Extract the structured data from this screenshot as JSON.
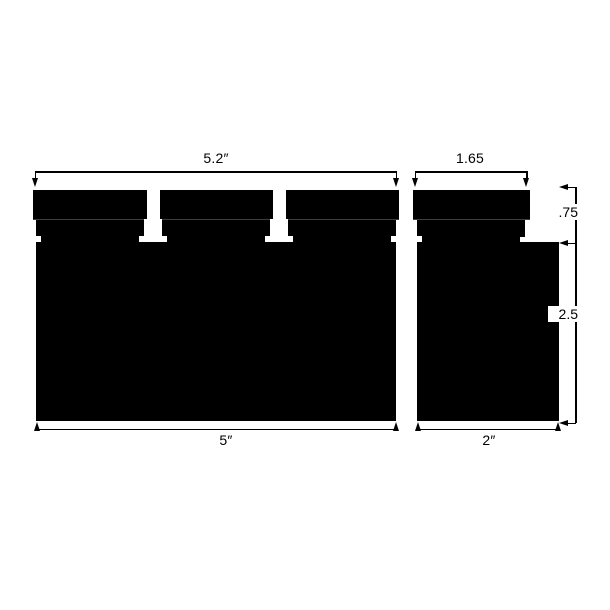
{
  "drawing": {
    "ink_color": "#000000",
    "background_color": "#ffffff",
    "left_part": {
      "top_width_label": "5.2″",
      "bottom_width_label": "5″"
    },
    "right_part": {
      "top_width_label": "1.65",
      "bottom_width_label": "2″"
    },
    "height_dims": {
      "top_section_label": ".75",
      "body_section_label": "2.5"
    }
  }
}
